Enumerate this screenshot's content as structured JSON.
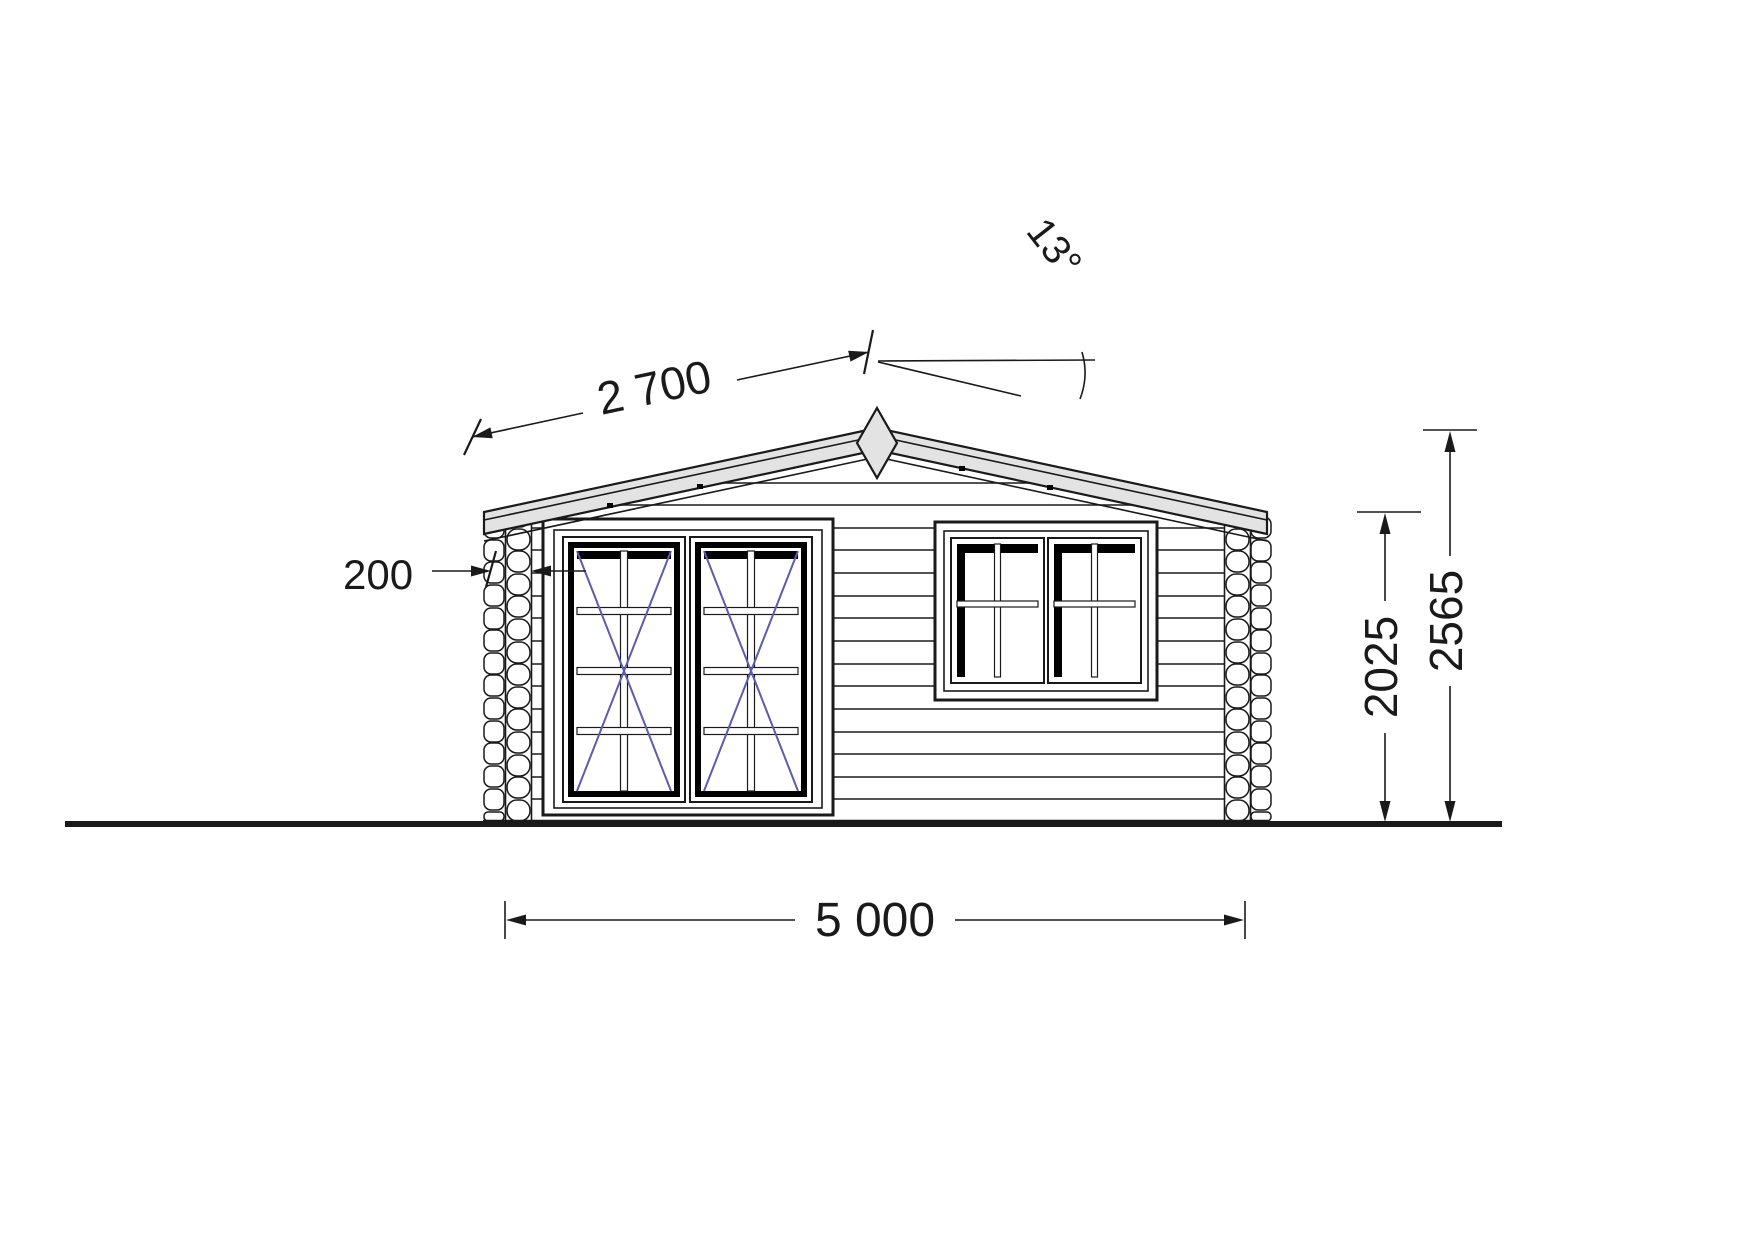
{
  "page": {
    "title": "Log cabin front elevation drawing",
    "background": "#ffffff"
  },
  "drawing": {
    "colors": {
      "line": "#1a1a1a",
      "roof_fill": "#e3e3e3",
      "glazing_diagonal": "#5c5caa",
      "shadow": "#000000"
    },
    "dimensions": {
      "roof_slope_length": {
        "label": "2 700"
      },
      "roof_angle": {
        "label": "13°"
      },
      "wall_thickness": {
        "label": "200"
      },
      "wall_height": {
        "label": "2025"
      },
      "ridge_height": {
        "label": "2565"
      },
      "overall_width": {
        "label": "5 000"
      }
    }
  }
}
